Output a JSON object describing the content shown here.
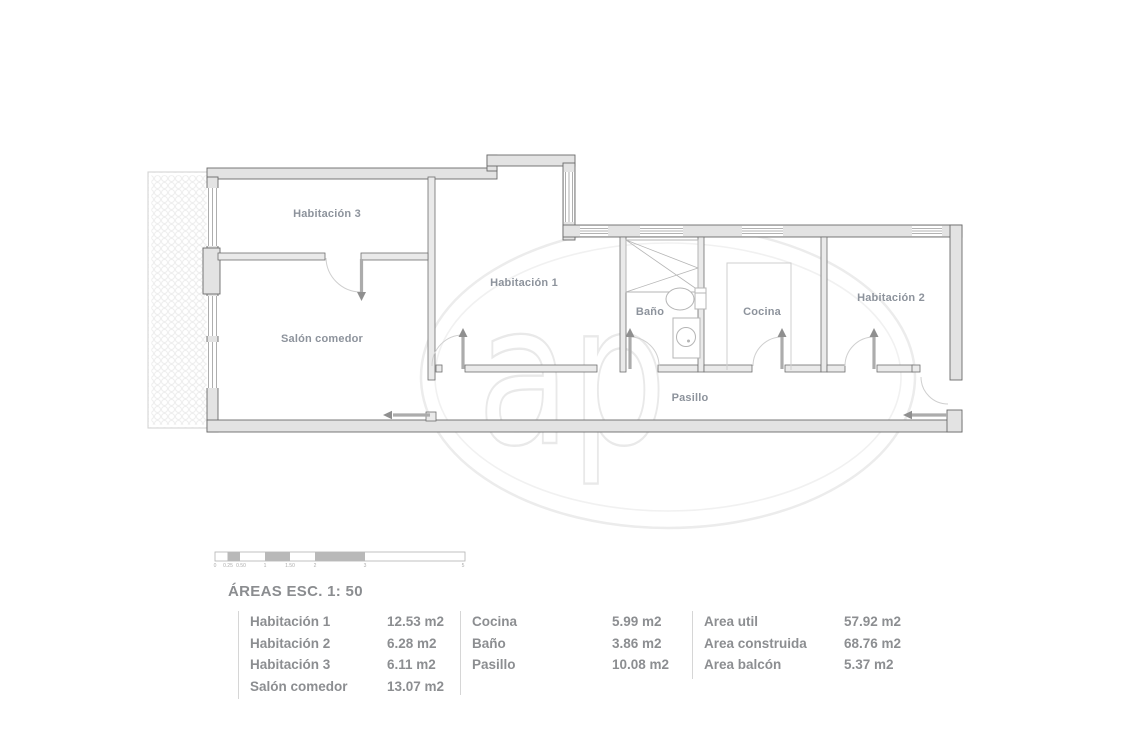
{
  "watermark": {
    "text": "ap"
  },
  "plan": {
    "rooms": [
      {
        "id": "habitacion-3",
        "label": "Habitación 3"
      },
      {
        "id": "salon-comedor",
        "label": "Salón comedor"
      },
      {
        "id": "habitacion-1",
        "label": "Habitación 1"
      },
      {
        "id": "bano",
        "label": "Baño"
      },
      {
        "id": "cocina",
        "label": "Cocina"
      },
      {
        "id": "habitacion-2",
        "label": "Habitación 2"
      },
      {
        "id": "pasillo",
        "label": "Pasillo"
      }
    ]
  },
  "scalebar": {
    "ticks": [
      "0",
      "0.25",
      "0.50",
      "1",
      "1.50",
      "2",
      "3",
      "5"
    ]
  },
  "areas": {
    "title": "ÁREAS ESC. 1: 50",
    "unit": "m2",
    "col1": {
      "rows": [
        {
          "name": "Habitación 1",
          "value": "12.53 m2"
        },
        {
          "name": "Habitación 2",
          "value": "6.28 m2"
        },
        {
          "name": "Habitación 3",
          "value": "6.11 m2"
        },
        {
          "name": "Salón comedor",
          "value": "13.07 m2"
        }
      ]
    },
    "col2": {
      "rows": [
        {
          "name": "Cocina",
          "value": "5.99 m2"
        },
        {
          "name": "Baño",
          "value": "3.86 m2"
        },
        {
          "name": "Pasillo",
          "value": "10.08 m2"
        }
      ]
    },
    "col3": {
      "rows": [
        {
          "name": "Area util",
          "value": "57.92 m2"
        },
        {
          "name": "Area construida",
          "value": "68.76 m2"
        },
        {
          "name": "Area balcón",
          "value": "5.37 m2"
        }
      ]
    }
  },
  "colors": {
    "wall_fill": "#e3e3e3",
    "wall_edge": "#6a6a6a",
    "label_gray": "#8d939c",
    "watermark_gray": "#ececec"
  }
}
